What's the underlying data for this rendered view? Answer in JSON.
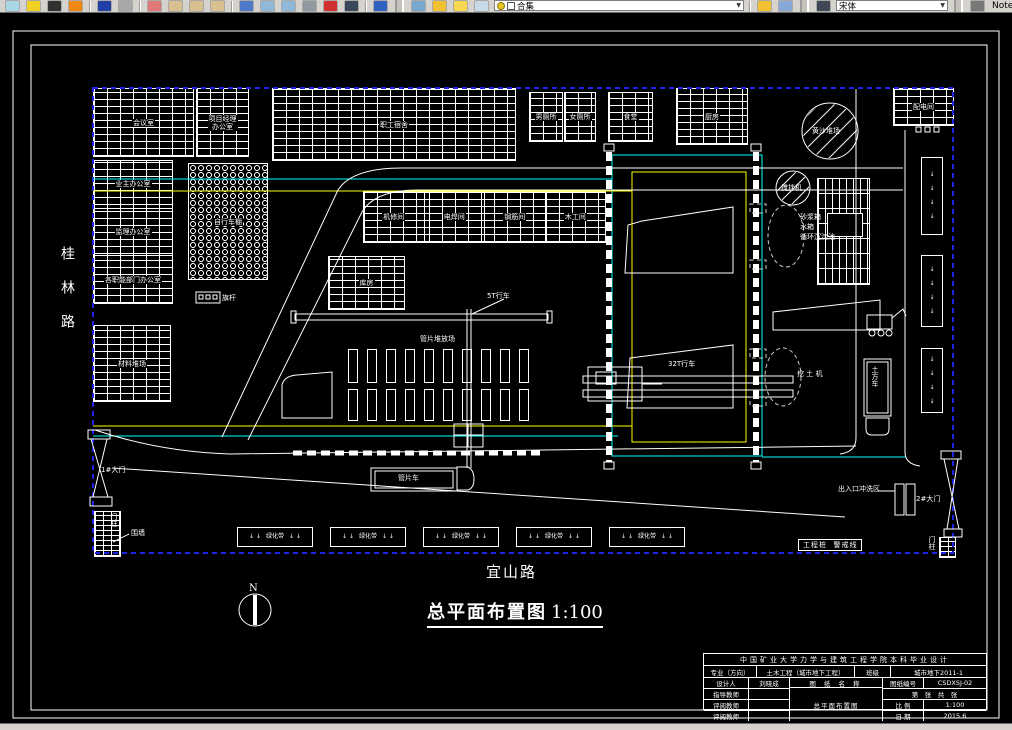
{
  "toolbar": {
    "items": [
      {
        "t": "icon",
        "name": "properties-icon",
        "c": "#a8d8e8"
      },
      {
        "t": "icon",
        "name": "match-properties-icon",
        "c": "#f0d020"
      },
      {
        "t": "icon",
        "name": "pencil-icon",
        "c": "#303030"
      },
      {
        "t": "icon",
        "name": "edit-polyline-icon",
        "c": "#f08818"
      },
      {
        "t": "sep"
      },
      {
        "t": "icon",
        "name": "arrow-down-icon",
        "c": "#2040a8"
      },
      {
        "t": "icon",
        "name": "arrow-down-disabled-icon",
        "c": "#a8a8a8"
      },
      {
        "t": "sep"
      },
      {
        "t": "icon",
        "name": "pan-realtime-icon",
        "c": "#e07878"
      },
      {
        "t": "icon",
        "name": "zoom-realtime-icon",
        "c": "#d8c090"
      },
      {
        "t": "icon",
        "name": "zoom-window-icon",
        "c": "#d8c090"
      },
      {
        "t": "icon",
        "name": "zoom-previous-icon",
        "c": "#d8c090"
      },
      {
        "t": "sep"
      },
      {
        "t": "icon",
        "name": "text-scale-icon",
        "c": "#5078c8"
      },
      {
        "t": "icon",
        "name": "table-icon",
        "c": "#90b8d8"
      },
      {
        "t": "icon",
        "name": "sheet-set-icon",
        "c": "#90b8d8"
      },
      {
        "t": "icon",
        "name": "plot-icon",
        "c": "#9098a0"
      },
      {
        "t": "icon",
        "name": "render-icon",
        "c": "#d03030"
      },
      {
        "t": "icon",
        "name": "grid-icon",
        "c": "#384858"
      },
      {
        "t": "sep"
      },
      {
        "t": "icon",
        "name": "help-icon",
        "c": "#3060c0"
      },
      {
        "t": "bigsep"
      },
      {
        "t": "icon",
        "name": "layers-icon",
        "c": "#78a8d0"
      },
      {
        "t": "icon",
        "name": "bulb-icon",
        "c": "#f0c030"
      },
      {
        "t": "icon",
        "name": "sun-icon",
        "c": "#f8d850"
      },
      {
        "t": "icon",
        "name": "freeze-layer-icon",
        "c": "#c8dce8"
      },
      {
        "t": "combo",
        "name": "layer-combo",
        "bind": "layer_combo_value",
        "w": 250,
        "prefix": true
      },
      {
        "t": "sep"
      },
      {
        "t": "icon",
        "name": "make-current-layer-icon",
        "c": "#f0c030"
      },
      {
        "t": "icon",
        "name": "layer-states-icon",
        "c": "#88a8d8"
      },
      {
        "t": "bigsep"
      },
      {
        "t": "icon",
        "name": "text-style-icon",
        "c": "#404858"
      },
      {
        "t": "combo",
        "name": "font-combo",
        "bind": "font_combo_value",
        "w": 112,
        "prefix": false
      },
      {
        "t": "bigsep"
      },
      {
        "t": "icon",
        "name": "dim-style-icon",
        "c": "#787878"
      },
      {
        "t": "label",
        "name": "note-label",
        "bind": "note_label"
      }
    ],
    "layer_combo_value": "合集",
    "font_combo_value": "宋体",
    "note_label": "Note"
  },
  "plan": {
    "left_road": "桂林路",
    "bottom_road": "宜山路",
    "drawing_title": "总平面布置图",
    "drawing_scale": "1:100",
    "north_label": "N",
    "buildings": [
      {
        "id": "meeting-room",
        "label": "会议室",
        "x": 93,
        "y": 88,
        "w": 101,
        "h": 69,
        "hatch": "brick"
      },
      {
        "id": "project-manager-office",
        "label": "项目经理\n办公室",
        "x": 196,
        "y": 88,
        "w": 53,
        "h": 69,
        "hatch": "brick"
      },
      {
        "id": "staff-dormitory",
        "label": "职工宿舍",
        "x": 272,
        "y": 88,
        "w": 244,
        "h": 73,
        "hatch": "brick"
      },
      {
        "id": "male-toilet",
        "label": "男厕所",
        "x": 529,
        "y": 92,
        "w": 34,
        "h": 50,
        "hatch": "brick"
      },
      {
        "id": "female-toilet",
        "label": "女厕所",
        "x": 564,
        "y": 92,
        "w": 32,
        "h": 50,
        "hatch": "brick"
      },
      {
        "id": "canteen",
        "label": "食堂",
        "x": 608,
        "y": 92,
        "w": 45,
        "h": 50,
        "hatch": "brick"
      },
      {
        "id": "kitchen",
        "label": "厨房",
        "x": 676,
        "y": 88,
        "w": 72,
        "h": 57,
        "hatch": "brick"
      },
      {
        "id": "power-distribution-room",
        "label": "配电间",
        "x": 893,
        "y": 88,
        "w": 61,
        "h": 38,
        "hatch": "brick"
      },
      {
        "id": "offices-block",
        "x": 93,
        "y": 160,
        "w": 80,
        "h": 144,
        "hatch": "brick",
        "dir": "col",
        "sublabels": [
          "业主办公室",
          "监理办公室",
          "各职能部门办公室"
        ]
      },
      {
        "id": "material-yard",
        "label": "材料堆场",
        "x": 93,
        "y": 325,
        "w": 78,
        "h": 77,
        "hatch": "brick"
      },
      {
        "id": "bicycle-shed",
        "label": "自行车棚",
        "x": 188,
        "y": 163,
        "w": 80,
        "h": 117,
        "hatch": "hex"
      },
      {
        "id": "storehouse",
        "label": "库房",
        "x": 328,
        "y": 256,
        "w": 77,
        "h": 54,
        "hatch": "brick"
      },
      {
        "id": "workshops",
        "x": 363,
        "y": 191,
        "w": 243,
        "h": 52,
        "hatch": "brick",
        "dir": "row",
        "sublabels": [
          "机修间",
          "电焊间",
          "钢筋间",
          "木工间"
        ]
      },
      {
        "id": "mortar-station",
        "x": 817,
        "y": 178,
        "w": 53,
        "h": 107,
        "hatch": "vbrick"
      },
      {
        "id": "mortar-station-inner",
        "x": 827,
        "y": 213,
        "w": 36,
        "h": 24,
        "hatch": "solid"
      }
    ],
    "labels": [
      {
        "id": "crane-5t",
        "text": "5T行车",
        "x": 487,
        "y": 292
      },
      {
        "id": "segment-yard",
        "text": "管片堆放场",
        "x": 420,
        "y": 335
      },
      {
        "id": "crane-32t",
        "text": "32T行车",
        "x": 668,
        "y": 360
      },
      {
        "id": "mixer",
        "text": "搅拌机",
        "x": 781,
        "y": 184
      },
      {
        "id": "sand-yard",
        "text": "黄沙堆场",
        "x": 812,
        "y": 127
      },
      {
        "id": "mortar-box",
        "text": "砂浆箱",
        "x": 800,
        "y": 213
      },
      {
        "id": "water-tank",
        "text": "水箱",
        "x": 800,
        "y": 223
      },
      {
        "id": "circulation-pool",
        "text": "循环沉淀池",
        "x": 800,
        "y": 233
      },
      {
        "id": "excavator",
        "text": "挖 土 机",
        "x": 797,
        "y": 370
      },
      {
        "id": "dump-truck",
        "text": "土方车",
        "x": 871,
        "y": 366,
        "vertical": true
      },
      {
        "id": "segment-truck",
        "text": "管片车",
        "x": 398,
        "y": 474
      },
      {
        "id": "wash-area",
        "text": "出入口冲洗区",
        "x": 838,
        "y": 485
      },
      {
        "id": "gate-1",
        "text": "1#大门",
        "x": 101,
        "y": 466
      },
      {
        "id": "gate-2",
        "text": "2#大门",
        "x": 916,
        "y": 495
      },
      {
        "id": "gate-1-pillar",
        "text": "门柱",
        "x": 110,
        "y": 513,
        "vertical": true
      },
      {
        "id": "gate-2-pillar",
        "text": "门柱",
        "x": 928,
        "y": 536,
        "vertical": true
      },
      {
        "id": "fence",
        "text": "围墙",
        "x": 131,
        "y": 529
      },
      {
        "id": "flagpole",
        "text": "旗杆",
        "x": 222,
        "y": 294
      },
      {
        "id": "warning-line",
        "text": "工程桩  警戒线",
        "x": 798,
        "y": 539,
        "boxed": true
      }
    ],
    "green_belt_label": "绿化带",
    "green_belts_horizontal": [
      {
        "x": 237,
        "y": 527,
        "w": 76,
        "h": 20
      },
      {
        "x": 330,
        "y": 527,
        "w": 76,
        "h": 20
      },
      {
        "x": 423,
        "y": 527,
        "w": 76,
        "h": 20
      },
      {
        "x": 516,
        "y": 527,
        "w": 76,
        "h": 20
      },
      {
        "x": 609,
        "y": 527,
        "w": 76,
        "h": 20
      }
    ],
    "green_belts_vertical": [
      {
        "x": 921,
        "y": 157,
        "w": 22,
        "h": 78
      },
      {
        "x": 921,
        "y": 255,
        "w": 22,
        "h": 72
      },
      {
        "x": 921,
        "y": 348,
        "w": 22,
        "h": 65
      }
    ],
    "segment_stacks": {
      "cols": 10,
      "col_start": 348,
      "col_step": 19,
      "col_w": 10,
      "rows": [
        {
          "y": 349,
          "h": 34
        },
        {
          "y": 389,
          "h": 32
        }
      ]
    },
    "pillars": [
      {
        "id": "gate-1-pillar-brick",
        "x": 94,
        "y": 511,
        "w": 27,
        "h": 46
      },
      {
        "id": "gate-2-pillar-brick",
        "x": 939,
        "y": 537,
        "w": 17,
        "h": 21
      }
    ]
  },
  "title_block": {
    "school_line": "中国矿业大学力学与建筑工程学院本科毕业设计",
    "major_label": "专业（方向）",
    "major_value": "土木工程（城市地下工程）",
    "class_label": "班级",
    "class_value": "城市地下2011-1",
    "rows": [
      {
        "label": "设计人",
        "value": "刘晓成"
      },
      {
        "label": "指导教师",
        "value": ""
      },
      {
        "label": "评阅教师",
        "value": ""
      },
      {
        "label": "评阅教师",
        "value": ""
      }
    ],
    "drawing_name_label": "图 纸 名 称",
    "drawing_name": "总平面布置图",
    "number_label": "图纸编号",
    "number_value": "CSDXSJ-02",
    "sheet_label": "第　张　共　张",
    "scale_label": "比 例",
    "scale_value": "1:100",
    "date_label": "日 期",
    "date_value": "2015.6"
  },
  "colors": {
    "boundary_blue": "#2222ee",
    "water_cyan": "#00ffff",
    "power_yellow": "#ffff00",
    "line_white": "#ffffff"
  }
}
